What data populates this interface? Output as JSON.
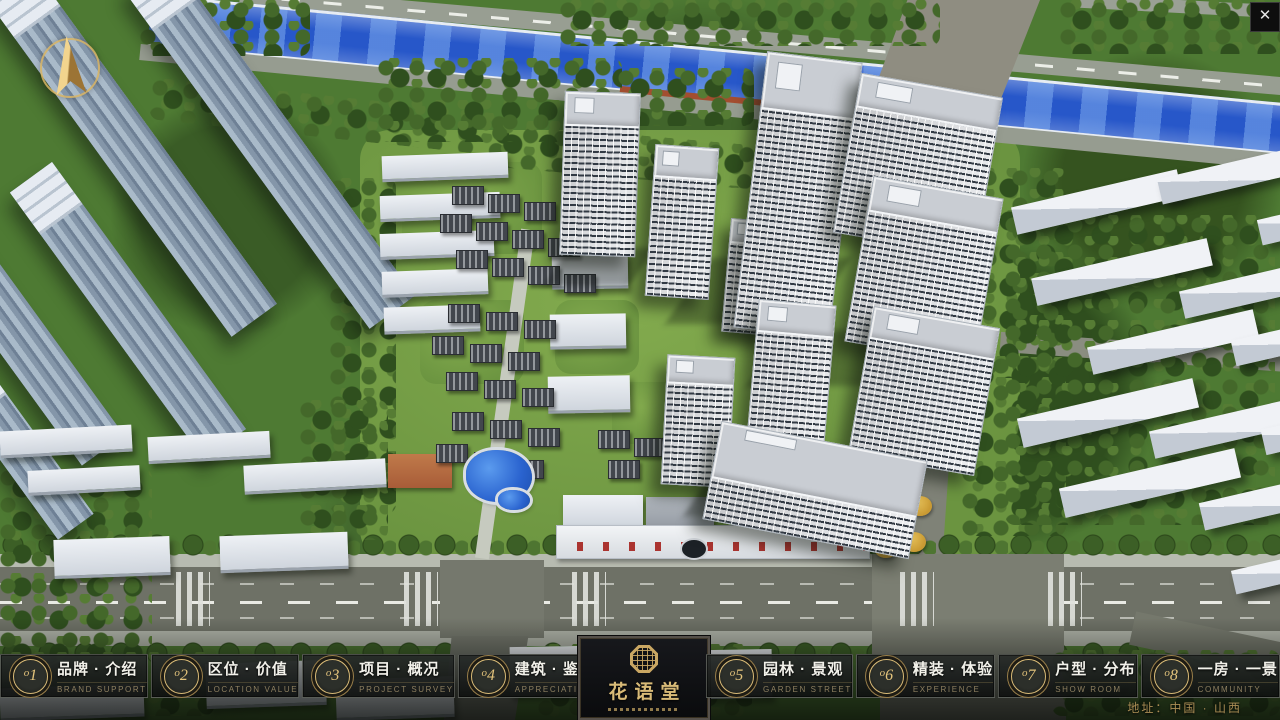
{
  "chrome": {
    "close_glyph": "✕"
  },
  "nav": {
    "items": [
      {
        "number": "o1",
        "zh": "品牌 · 介绍",
        "en": "BRAND SUPPORT"
      },
      {
        "number": "o2",
        "zh": "区位 · 价值",
        "en": "LOCATION VALUE"
      },
      {
        "number": "o3",
        "zh": "项目 · 概况",
        "en": "PROJECT SURVEY"
      },
      {
        "number": "o4",
        "zh": "建筑 · 鉴赏",
        "en": "APPRECIATION"
      },
      {
        "number": "o5",
        "zh": "园林 · 景观",
        "en": "GARDEN STREET"
      },
      {
        "number": "o6",
        "zh": "精装 · 体验",
        "en": "EXPERIENCE"
      },
      {
        "number": "o7",
        "zh": "户型 · 分布",
        "en": "SHOW ROOM"
      },
      {
        "number": "o8",
        "zh": "一房 · 一景",
        "en": "COMMUNITY"
      }
    ]
  },
  "logo": {
    "name": "花语堂"
  },
  "footer": {
    "address": "地址：中国 · 山西"
  },
  "colors": {
    "gold": "#c9a45a",
    "text": "#f2f1ea",
    "subtext": "#8d7f60",
    "panel_bg": "#15171a",
    "river": "#2757c9"
  }
}
